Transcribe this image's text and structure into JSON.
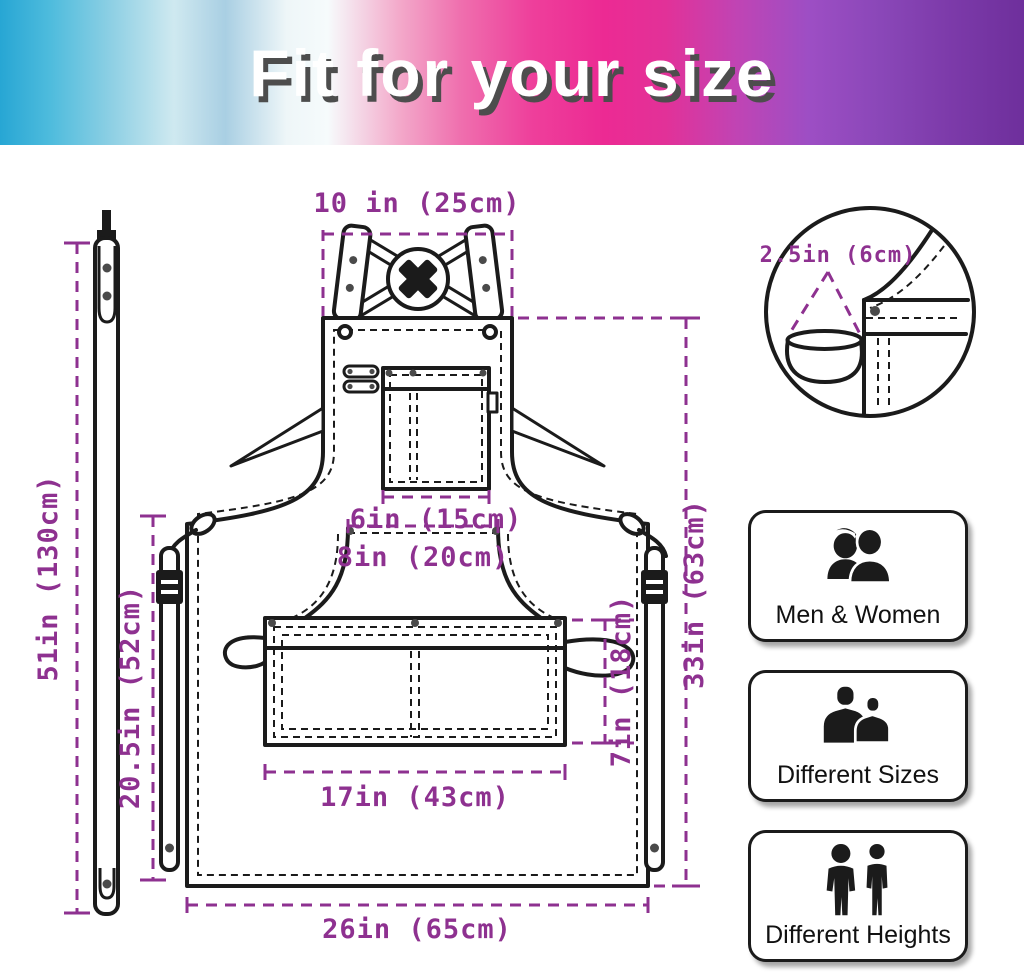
{
  "banner": {
    "title": "Fit for your size"
  },
  "diagram": {
    "dimension_color": "#8e3190",
    "line_color": "#1b1b1b",
    "labels": {
      "neck_strap_width": "10 in (25cm)",
      "chest_pocket_width": "6in (15cm)",
      "center_panel_top_width": "8in (20cm)",
      "front_pocket_width": "17in (43cm)",
      "front_pocket_height": "7in (18cm)",
      "lower_section_height": "20.5in (52cm)",
      "body_length": "33in (63cm)",
      "bottom_width": "26in (65cm)",
      "waist_strap_length": "51in (130cm)",
      "side_loop_width": "2.5in (6cm)"
    }
  },
  "features": [
    {
      "label": "Men & Women"
    },
    {
      "label": "Different Sizes"
    },
    {
      "label": "Different Heights"
    }
  ]
}
